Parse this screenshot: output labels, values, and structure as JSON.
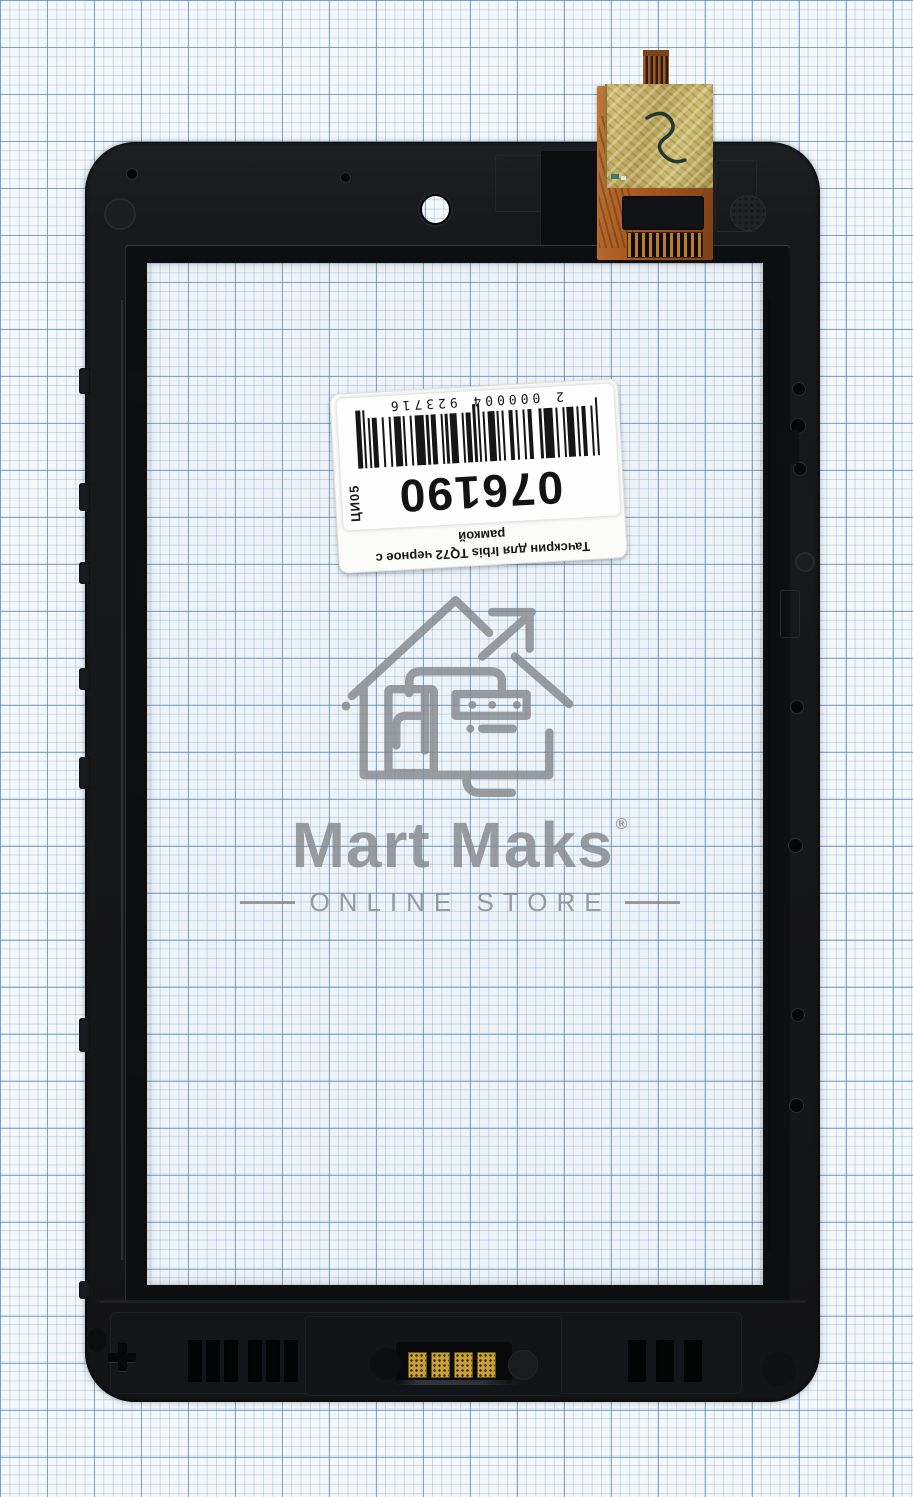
{
  "photo": {
    "subject": "touchscreen-digitizer-with-frame-product-photo"
  },
  "frame": {
    "embossed_line1": "130306",
    "embossed_line2": "S760D",
    "color": "#17181b"
  },
  "label": {
    "title_line1": "Тачскрин для Irbis TQ72 черное с",
    "title_line2": "рамкой",
    "item_number": "076190",
    "side_code": "ЦИ05",
    "barcode": {
      "digits": "2 000004 923716",
      "module_px": 2.35,
      "bar_height": 50,
      "tall_bar_height": 58,
      "sequence": "t1,1,1,2,2,1,1,1,3,1,1,2,1,1,4,1,1,3,2,1,1,2,1,1,2,2,1,1,1,1,3,1,1,1,t1,1,t1,1,2,1,1,2,3,1,1,1,1,2,2,1,1,1,4,1,1,2,1,1,3,1,1,2,1,2,2,1,1,1,t1,1,t2"
    }
  },
  "watermark": {
    "logo_icon": "house-arrow-icon",
    "brand": "Mart Maks",
    "brand_mark": "®",
    "subtitle": "ONLINE STORE",
    "color": "#85898d"
  },
  "colors": {
    "paper_bg": "#f4f8fb",
    "paper_fine_line": "#7daad2",
    "paper_major_line": "#467daf",
    "frame_black": "#17181b",
    "flex_copper": "#b4662c",
    "gold_tape": "#cdbd72",
    "gold_pad": "#c9a035",
    "barcode_ink": "#161616"
  }
}
